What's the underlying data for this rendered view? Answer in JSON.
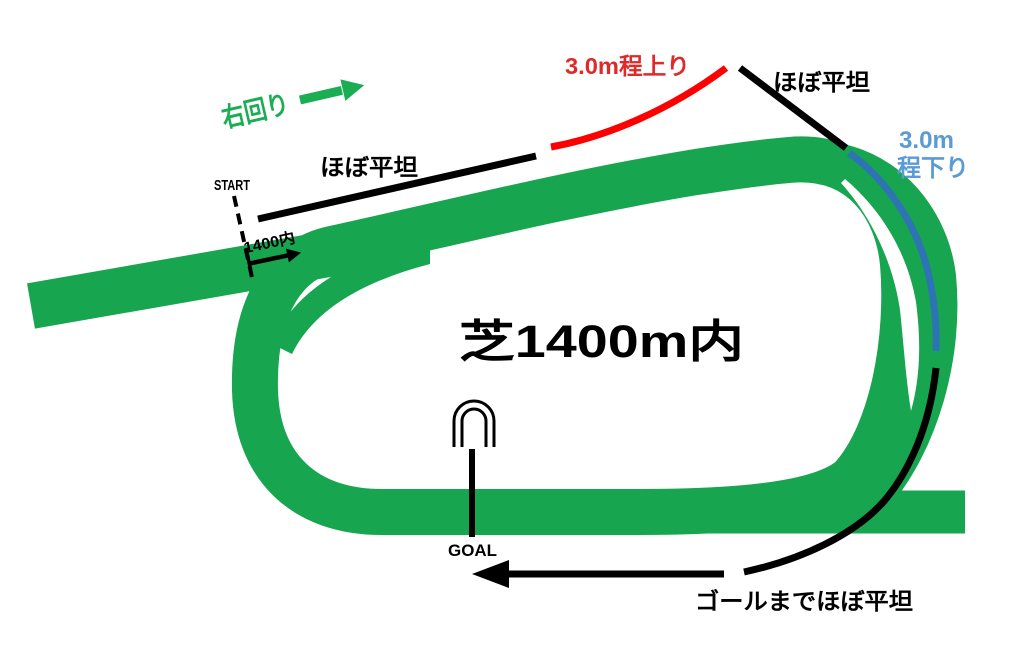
{
  "course": {
    "title": "芝1400m内",
    "direction_label": "右回り",
    "start_label": "START",
    "distance_marker": "1400内",
    "goal_label": "GOAL",
    "sections": {
      "backstretch_flat": "ほぼ平坦",
      "uphill": "3.0m程上り",
      "crest_flat": "ほぼ平坦",
      "downhill_line1": "3.0m",
      "downhill_line2": "程下り",
      "home_stretch_flat": "ゴールまでほぼ平坦"
    },
    "colors": {
      "track_green": "#17A550",
      "accent_green": "#1BAD53",
      "uphill_red": "#FF0000",
      "uphill_text_red": "#E02A2A",
      "downhill_blue": "#2E74B5",
      "downhill_text_blue": "#5B9BD5",
      "line_black": "#000000",
      "background_white": "#FFFFFF"
    }
  }
}
